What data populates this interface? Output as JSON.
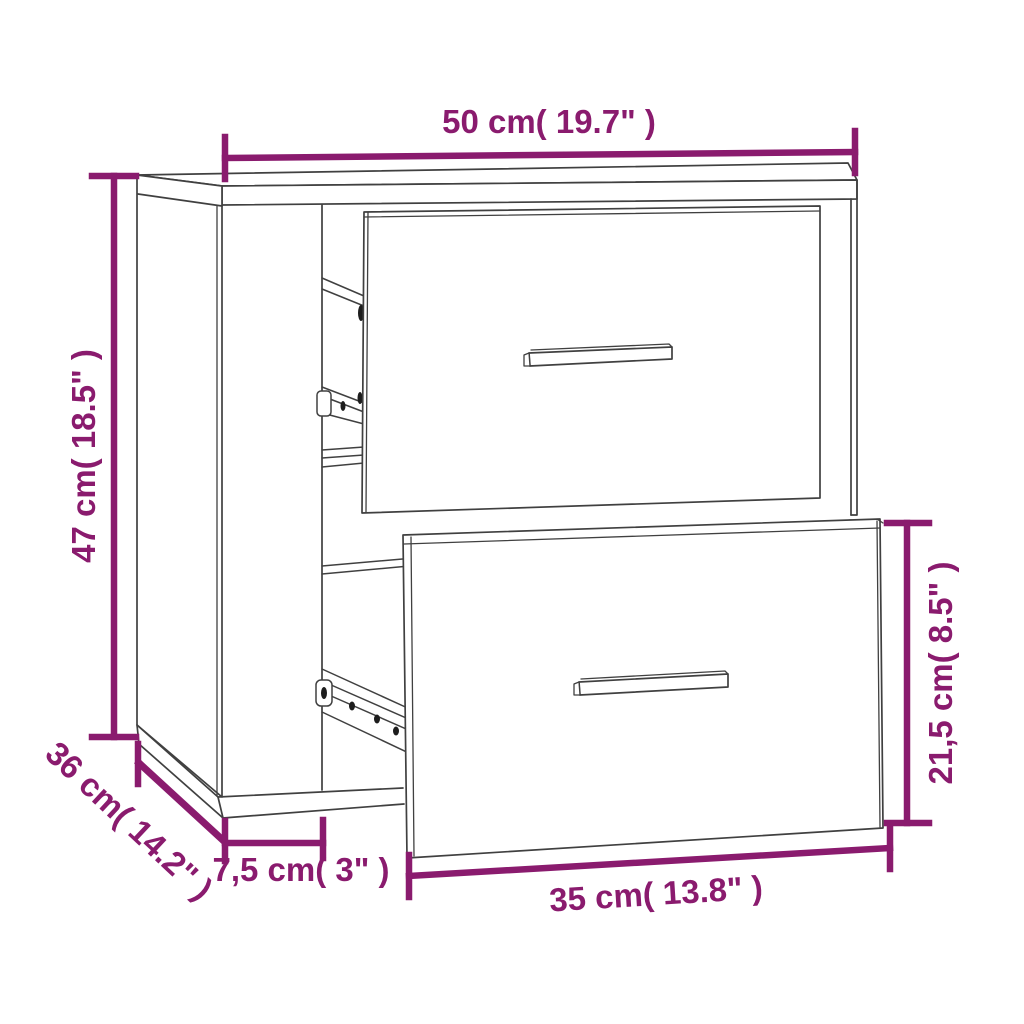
{
  "diagram": {
    "type": "product-dimension-diagram",
    "product": "wall-mounted bedside cabinet with two pull-out drawers",
    "background_color": "#ffffff",
    "accent_color": "#8A1B6E",
    "line_color": "#404040",
    "dimensions": [
      {
        "id": "overall-width",
        "label": "50 cm( 19.7\" )",
        "position": "top"
      },
      {
        "id": "overall-height",
        "label": "47 cm( 18.5\" )",
        "position": "left"
      },
      {
        "id": "overall-depth",
        "label": "36 cm( 14.2\" )",
        "position": "bottom-left-diagonal"
      },
      {
        "id": "side-offset",
        "label": "7,5 cm( 3\" )",
        "position": "bottom"
      },
      {
        "id": "drawer-width",
        "label": "35 cm( 13.8\" )",
        "position": "bottom-drawer"
      },
      {
        "id": "drawer-height",
        "label": "21,5 cm( 8.5\" )",
        "position": "right-drawer"
      }
    ]
  }
}
